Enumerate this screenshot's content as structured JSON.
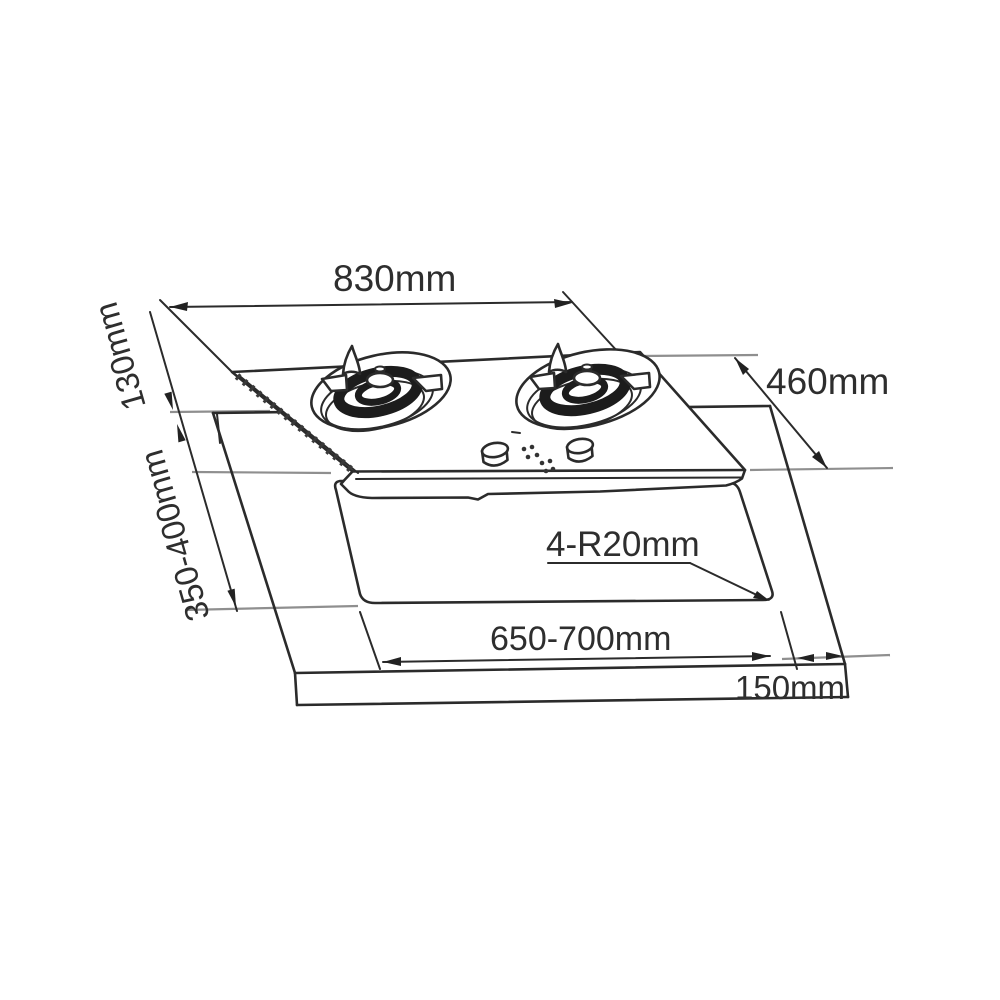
{
  "diagram": {
    "type": "technical-installation-drawing",
    "subject": "two-burner built-in gas hob with countertop cutout",
    "line_color": "#2b2b2b",
    "reference_line_color": "#8f8f8f",
    "background": "#ffffff",
    "dimensions": {
      "hob_width": "830mm",
      "hob_depth": "460mm",
      "back_offset": "130mm",
      "cutout_depth": "350-400mm",
      "cutout_corner_radius": "4-R20mm",
      "cutout_width": "650-700mm",
      "side_margin": "150mm"
    }
  }
}
